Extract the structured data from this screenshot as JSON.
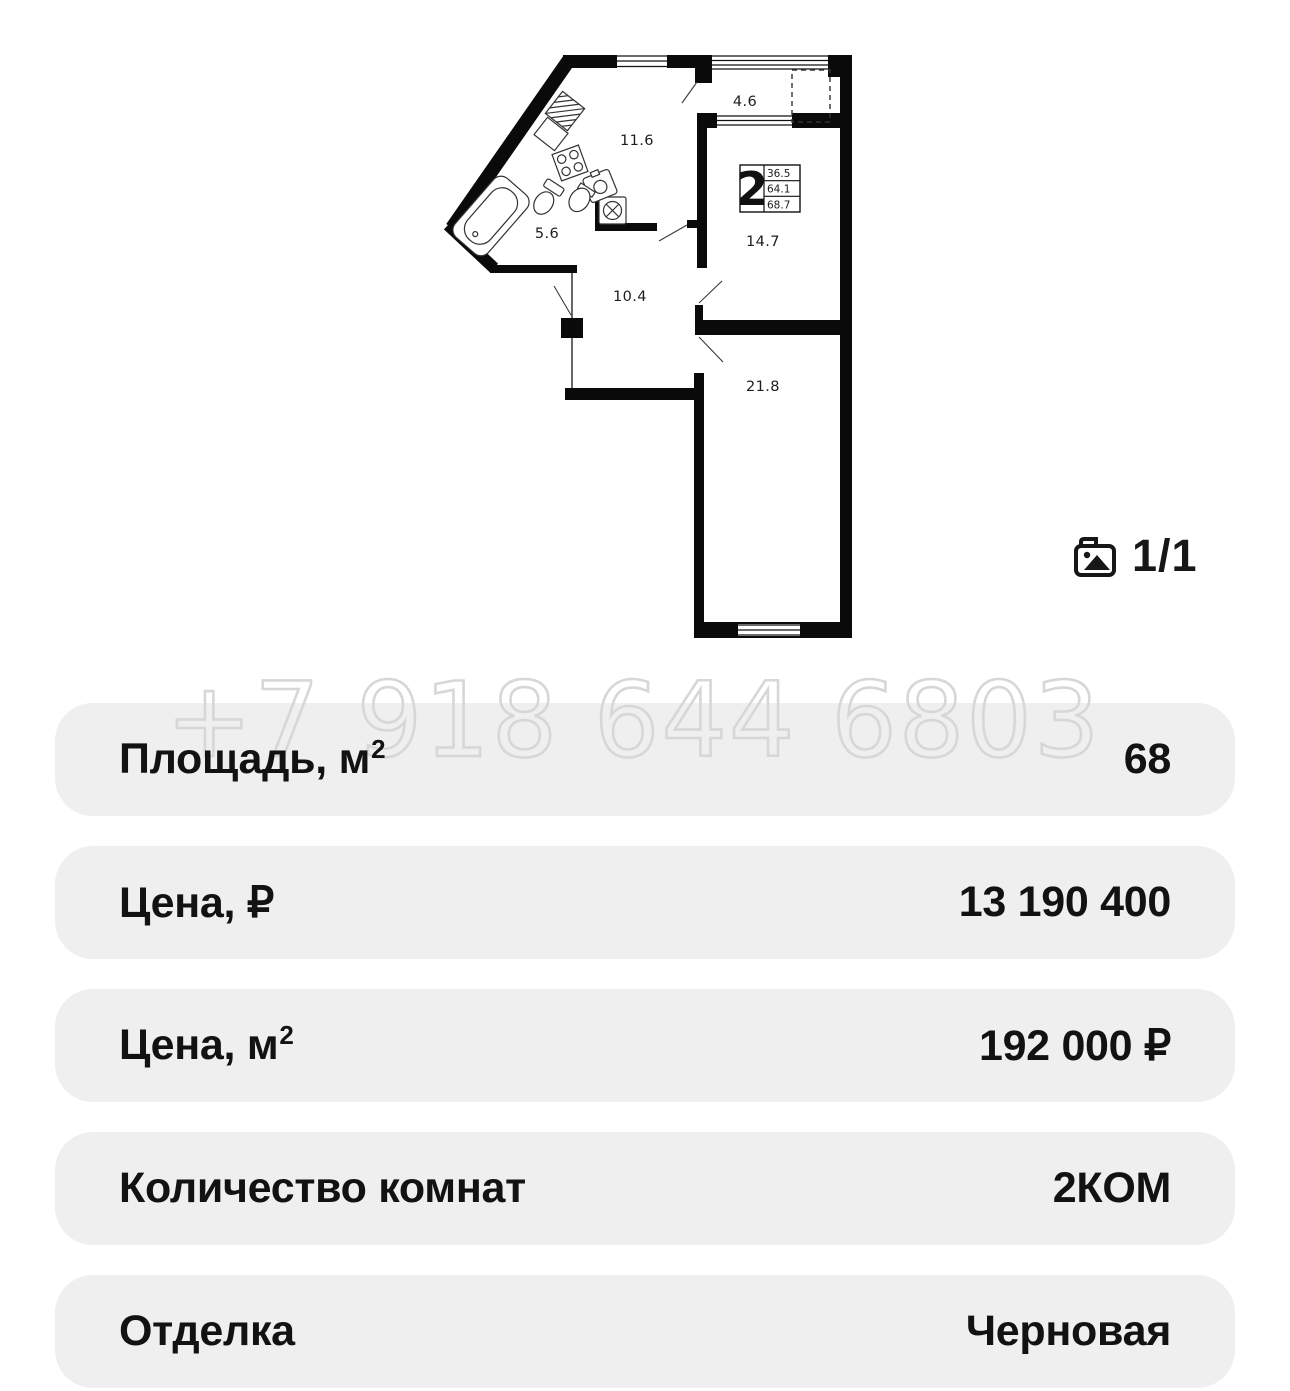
{
  "watermark": "+7 918 644 6803",
  "photo_counter": {
    "label": "1/1"
  },
  "floor_plan": {
    "unit_type": "2",
    "areas_box": {
      "row1": "36.5",
      "row2": "64.1",
      "row3": "68.7"
    },
    "rooms": [
      {
        "id": "kitchen-living",
        "area": "11.6"
      },
      {
        "id": "balcony",
        "area": "4.6"
      },
      {
        "id": "bathroom",
        "area": "5.6"
      },
      {
        "id": "hallway",
        "area": "10.4"
      },
      {
        "id": "room-middle",
        "area": "14.7"
      },
      {
        "id": "room-bottom",
        "area": "21.8"
      }
    ]
  },
  "details": {
    "rows": [
      {
        "label": "Площадь, м",
        "sup": "2",
        "value": "68"
      },
      {
        "label": "Цена, ₽",
        "sup": "",
        "value": "13 190 400"
      },
      {
        "label": "Цена, м",
        "sup": "2",
        "value": "192 000 ₽"
      },
      {
        "label": "Количество комнат",
        "sup": "",
        "value": "2КОМ"
      },
      {
        "label": "Отделка",
        "sup": "",
        "value": "Черновая"
      }
    ]
  },
  "colors": {
    "row_bg": "#efefef",
    "ink": "#111111",
    "watermark_outline": "#d7d7d7"
  }
}
